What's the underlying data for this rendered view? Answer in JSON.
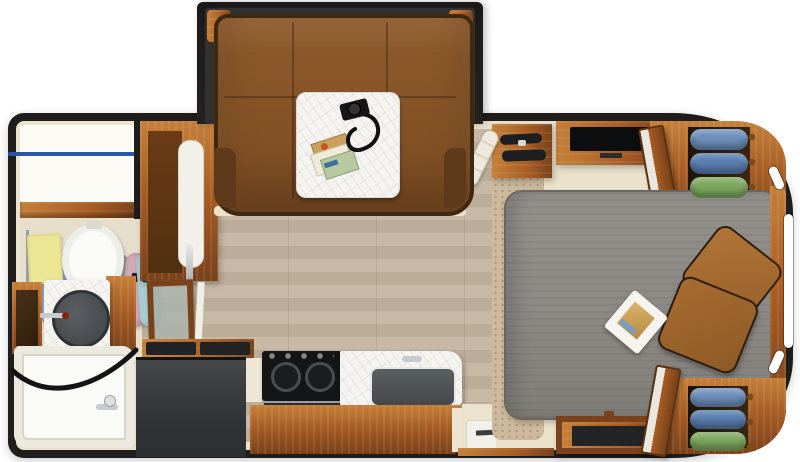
{
  "scene": {
    "type": "travel-trailer-floorplan-top-down-render",
    "width_px": 800,
    "height_px": 462,
    "sections_left_to_right": [
      "rear-bathroom",
      "wardrobe-refrigerator-cabinet",
      "dinette-slideout",
      "kitchen",
      "entry",
      "front-bedroom"
    ]
  },
  "palette": {
    "background": "#ffffff",
    "wall": "#1f1e1c",
    "trim": "#ece3cd",
    "floor_a": "#c7b9a6",
    "floor_b": "#bcad99",
    "stone_a": "#ccb99e",
    "stone_b": "#c3ad90",
    "wood": "#a85d24",
    "wood_light": "#c5803a",
    "wood_dark": "#7a421a",
    "sofa": "#8f5a2b",
    "sofa_dark": "#5e3a1b",
    "marble": "#f5f4f1",
    "bed": "#8d8a86",
    "bed_dark": "#6a6763",
    "pillow": "#a96b31",
    "fridge": "#3a3d40",
    "appliance": "#141517",
    "porcelain": "#fafaf6",
    "towel": "#ece594",
    "sink_basin": "#4e5254",
    "steel": "#c7cbcd",
    "glass": "#aab4ae",
    "rod_blue": "#2e55a5",
    "cream_panel": "#f2f0e9"
  },
  "slideout_dinette": {
    "name": "u-shaped-dinette-slideout",
    "sofa_finish": "brown-leather",
    "table_finish": "white-marble",
    "table_items": [
      "camera-with-neck-strap",
      "travel-magazines",
      "brochures"
    ]
  },
  "bathroom": {
    "closet": {
      "garment_colors": [
        "#8ba3c9",
        "#8ba3c9",
        "#9dbd8d",
        "#9dbd8d",
        "#d6a9ba",
        "#a6cdd1"
      ],
      "rod_color": "#2e55a5"
    },
    "fixtures": [
      "towel-rack-with-yellow-towel",
      "toilet",
      "round-vessel-sink-vanity",
      "mirror-base-cabinet",
      "bathtub-with-curved-shower-rod",
      "frosted-glass-bath-door"
    ],
    "towel_color": "#ece594"
  },
  "hall_cabinet": {
    "name": "refrigerator-pantry-cabinet",
    "door_color": "#f3f1ea",
    "handle_finish": "chrome"
  },
  "kitchen": {
    "appliances": [
      "black-refrigerator",
      "flip-up-glass-range-covers",
      "cooktop-with-two-burners",
      "oven-drawer",
      "undermount-kitchen-sink"
    ],
    "counter_finish": "white-marble",
    "cabinet_finish": "warm-wood"
  },
  "entry": {
    "items": [
      "entry-step-well",
      "white-grab-handle",
      "entry-steps-cabinet"
    ]
  },
  "bedroom": {
    "bed": {
      "mattress_color": "#8d8a86",
      "pillow_colors": [
        "#b27536",
        "#a86c30"
      ],
      "on_bed": [
        "travel-magazine"
      ]
    },
    "wardrobe_top": {
      "folded_clothes_colors": [
        "#6e90bc",
        "#5a7fb0",
        "#7da85f"
      ]
    },
    "wardrobe_bottom": {
      "folded_clothes_colors": [
        "#6e90bc",
        "#5a7fb0",
        "#7da85f"
      ]
    },
    "furniture": [
      "tv-dresser",
      "flat-tv",
      "media-chest",
      "front-wardrobes-with-open-doors",
      "headboard-rail"
    ],
    "windows": [
      "front-cap-upper-window",
      "front-cap-center-window",
      "front-cap-lower-window"
    ]
  }
}
